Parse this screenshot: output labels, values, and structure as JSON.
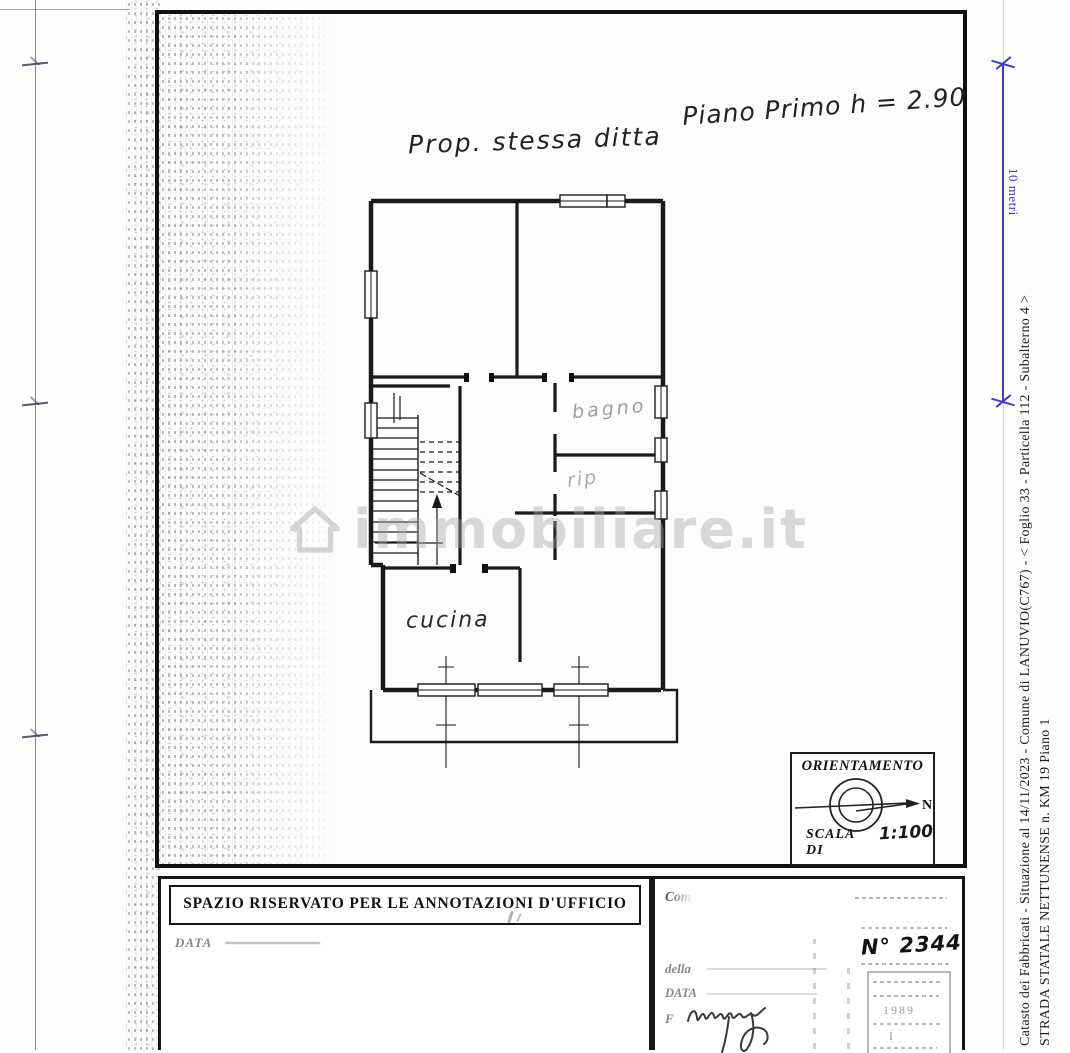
{
  "watermark": {
    "text": "immobiliare.it"
  },
  "notes": {
    "property": "Prop. stessa ditta",
    "floor": "Piano Primo h = 2.90"
  },
  "rooms": {
    "bathroom": "bagno",
    "storage": "rip",
    "kitchen": "cucina"
  },
  "compass": {
    "title": "ORIENTAMENTO",
    "north": "N",
    "scale_label": "SCALA DI",
    "scale_value": "1:100"
  },
  "office_box": {
    "header": "SPAZIO RISERVATO PER LE ANNOTAZIONI D'UFFICIO",
    "date_label": "DATA"
  },
  "clerk_box": {
    "compiled_label": "Comp",
    "della_label": "della",
    "date_label": "DATA",
    "signature_label": "F",
    "protocol_number": "N° 2344",
    "stamp_marks": [
      "1989",
      "I"
    ]
  },
  "scale_bar": {
    "label": "10 metri",
    "color": "#3b3bd1"
  },
  "side_caption": {
    "line1": "Catasto dei Fabbricati - Situazione al 14/11/2023 - Comune di LANUVIO(C767) - <  Foglio 33 - Particella  112 - Subalterno 4 >",
    "line2": "STRADA STATALE NETTUNENSE n. KM 19 Piano 1"
  }
}
